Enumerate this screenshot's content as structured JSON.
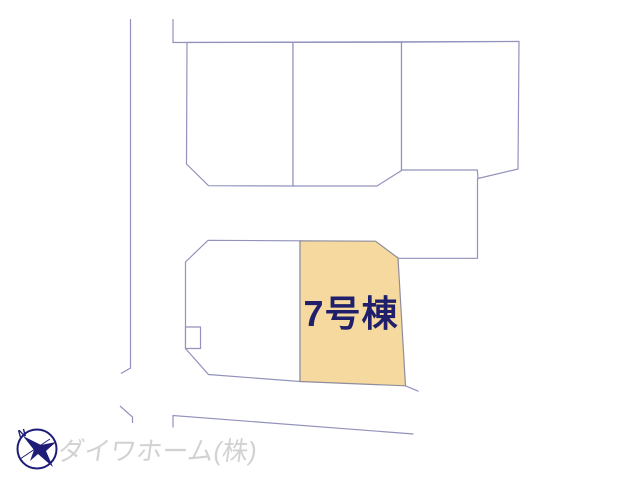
{
  "diagram": {
    "type": "residential-site-plan",
    "upper_parcel_count": 3,
    "lower_parcel_count": 2,
    "line_color": "#9292bd",
    "highlighted_parcel": {
      "label": "7号棟",
      "fill_color": "#f6d99e",
      "label_color": "#1f1f6b"
    }
  },
  "compass": {
    "label": "N",
    "color": "#1d1d78"
  },
  "watermark": {
    "company_name": "ダイワホーム(株)",
    "color": "#d2d2d2"
  }
}
